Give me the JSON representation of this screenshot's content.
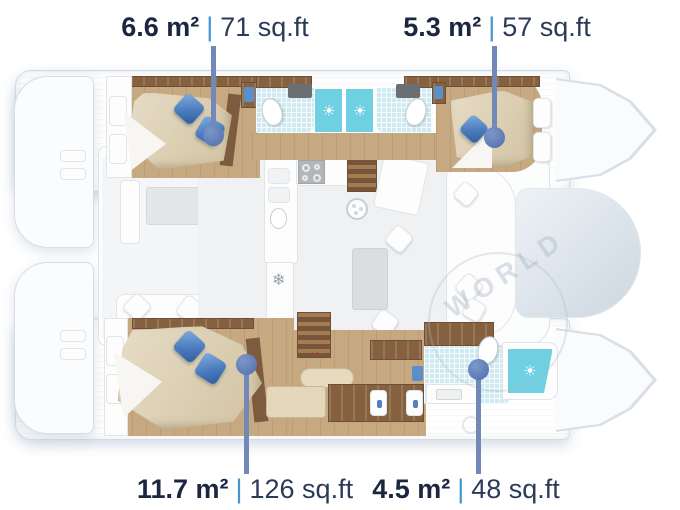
{
  "labels": {
    "top_left": {
      "metric": "6.6 m²",
      "separator": "|",
      "imperial": "71 sq.ft"
    },
    "top_right": {
      "metric": "5.3 m²",
      "separator": "|",
      "imperial": "57 sq.ft"
    },
    "bottom_left": {
      "metric": "11.7 m²",
      "separator": "|",
      "imperial": "126 sq.ft"
    },
    "bottom_right": {
      "metric": "4.5 m²",
      "separator": "|",
      "imperial": "48 sq.ft"
    }
  },
  "watermark": {
    "text": "WORLD"
  },
  "icons": {
    "shower_drain": "☀",
    "fridge_snowflake": "❄",
    "stairs_direction_arrow": "↔"
  },
  "colors": {
    "label_metric": "#1b2640",
    "label_imperial": "#2b3a58",
    "separator_blue": "#4296d2",
    "leader_line": "#7289b7",
    "leader_dot": "#5b79b5",
    "wood_floor": "#c6a981",
    "wood_cabinet": "#86613f",
    "bed_beige": "#ddd2b8",
    "pillow_blue": "#4f82c0",
    "shower_aqua": "#6fd0e2",
    "tile_aqua": "#cfeaf0",
    "hull_white": "#fafbfc",
    "salon_floor": "#eff1f2"
  }
}
